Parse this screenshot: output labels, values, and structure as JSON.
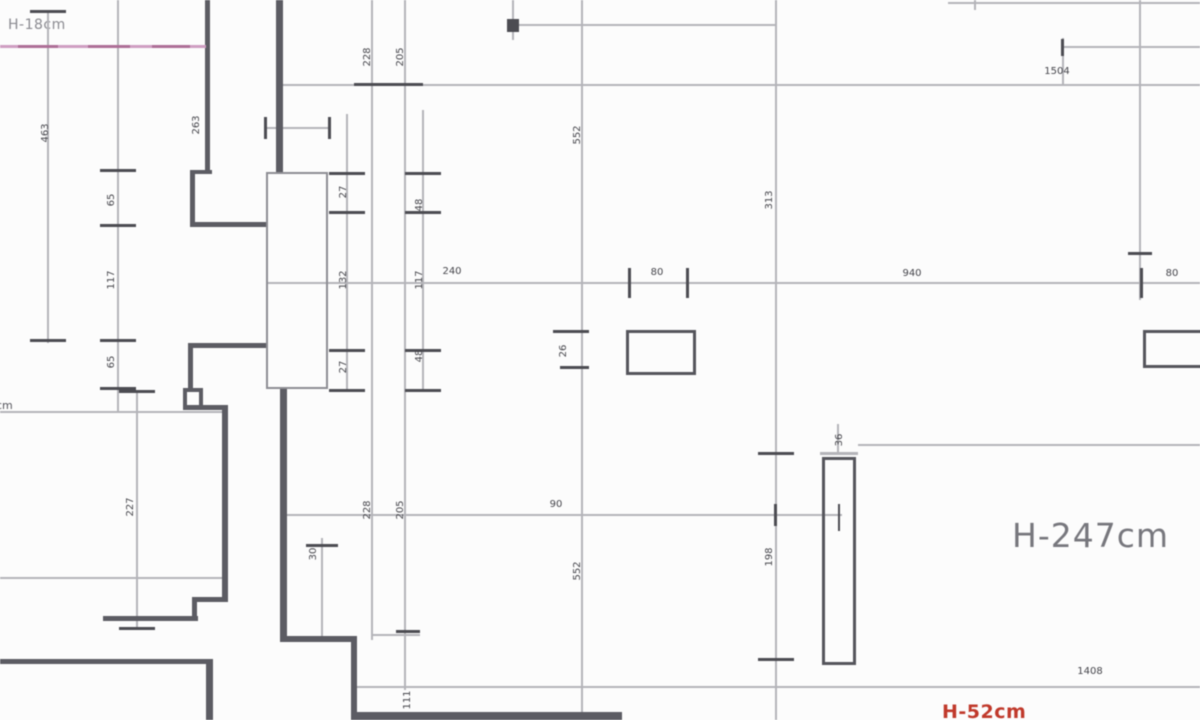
{
  "meta": {
    "app": "architectural-floor-plan-view",
    "canvas_width": 1200,
    "canvas_height": 720
  },
  "labels": {
    "top_left_height": "H-18cm",
    "main_height": "H-247cm",
    "left_edge_cut": "cm",
    "bottom_red_height": "H-52cm"
  },
  "colors": {
    "background": "#fcfcfc",
    "wall": "#5c5c63",
    "dimension_line": "#b4b4b9",
    "tick": "#4c4c52",
    "dimension_text": "#45454b",
    "big_label": "#77777d",
    "pink_line": "#cf9ec2",
    "pink_dash": "#ad6f97",
    "red_label": "#c0392b"
  },
  "drawing": {
    "pink_line": {
      "x": 0,
      "y": 45,
      "w": 206,
      "h": 3,
      "dashes": [
        [
          18,
          40
        ],
        [
          88,
          42
        ],
        [
          152,
          38
        ]
      ]
    },
    "walls": [
      {
        "x": 205,
        "y": 0,
        "w": 5,
        "h": 173
      },
      {
        "x": 190,
        "y": 170,
        "w": 22,
        "h": 4
      },
      {
        "x": 190,
        "y": 170,
        "w": 5,
        "h": 57
      },
      {
        "x": 190,
        "y": 222,
        "w": 78,
        "h": 5
      },
      {
        "x": 188,
        "y": 343,
        "w": 80,
        "h": 5
      },
      {
        "x": 188,
        "y": 343,
        "w": 5,
        "h": 47
      },
      {
        "x": 276,
        "y": 0,
        "w": 7,
        "h": 174
      },
      {
        "x": 280,
        "y": 388,
        "w": 7,
        "h": 253
      },
      {
        "x": 280,
        "y": 636,
        "w": 77,
        "h": 6
      },
      {
        "x": 351,
        "y": 636,
        "w": 6,
        "h": 84
      },
      {
        "x": 352,
        "y": 712,
        "w": 270,
        "h": 8
      },
      {
        "x": 0,
        "y": 659,
        "w": 213,
        "h": 5
      },
      {
        "x": 206,
        "y": 659,
        "w": 7,
        "h": 61
      },
      {
        "x": 222,
        "y": 405,
        "w": 6,
        "h": 196
      },
      {
        "x": 183,
        "y": 405,
        "w": 45,
        "h": 5
      },
      {
        "x": 183,
        "y": 388,
        "w": 4,
        "h": 19
      },
      {
        "x": 183,
        "y": 388,
        "w": 20,
        "h": 4
      },
      {
        "x": 199,
        "y": 388,
        "w": 4,
        "h": 19
      },
      {
        "x": 192,
        "y": 597,
        "w": 36,
        "h": 5
      },
      {
        "x": 192,
        "y": 597,
        "w": 5,
        "h": 23
      },
      {
        "x": 103,
        "y": 616,
        "w": 95,
        "h": 5
      }
    ],
    "dim_lines": [
      {
        "x": 47,
        "y": 10,
        "w": 2,
        "h": 333
      },
      {
        "x": 117,
        "y": 0,
        "w": 2,
        "h": 412
      },
      {
        "x": 136,
        "y": 390,
        "w": 2,
        "h": 240
      },
      {
        "x": 346,
        "y": 114,
        "w": 2,
        "h": 278
      },
      {
        "x": 321,
        "y": 538,
        "w": 2,
        "h": 100
      },
      {
        "x": 371,
        "y": 0,
        "w": 2,
        "h": 640
      },
      {
        "x": 404,
        "y": 0,
        "w": 2,
        "h": 690
      },
      {
        "x": 422,
        "y": 110,
        "w": 2,
        "h": 282
      },
      {
        "x": 512,
        "y": 0,
        "w": 2,
        "h": 40
      },
      {
        "x": 581,
        "y": 0,
        "w": 2,
        "h": 720
      },
      {
        "x": 775,
        "y": 0,
        "w": 2,
        "h": 720
      },
      {
        "x": 1139,
        "y": 0,
        "w": 2,
        "h": 300
      },
      {
        "x": 513,
        "y": 24,
        "w": 263,
        "h": 2
      },
      {
        "x": 1063,
        "y": 46,
        "w": 137,
        "h": 2
      },
      {
        "x": 948,
        "y": 2,
        "w": 252,
        "h": 2
      },
      {
        "x": 283,
        "y": 84,
        "w": 917,
        "h": 2
      },
      {
        "x": 266,
        "y": 282,
        "w": 934,
        "h": 2
      },
      {
        "x": 265,
        "y": 127,
        "w": 65,
        "h": 2
      },
      {
        "x": 0,
        "y": 411,
        "w": 222,
        "h": 2
      },
      {
        "x": 287,
        "y": 514,
        "w": 555,
        "h": 2
      },
      {
        "x": 0,
        "y": 577,
        "w": 225,
        "h": 2
      },
      {
        "x": 352,
        "y": 686,
        "w": 848,
        "h": 2
      },
      {
        "x": 372,
        "y": 634,
        "w": 48,
        "h": 2
      },
      {
        "x": 974,
        "y": 0,
        "w": 2,
        "h": 10
      },
      {
        "x": 1062,
        "y": 38,
        "w": 2,
        "h": 47
      },
      {
        "x": 858,
        "y": 444,
        "w": 342,
        "h": 2
      },
      {
        "x": 820,
        "y": 452,
        "w": 38,
        "h": 3
      },
      {
        "x": 837,
        "y": 424,
        "w": 2,
        "h": 30
      }
    ],
    "ticks": [
      {
        "x": 100,
        "y": 169,
        "w": 36,
        "h": 3
      },
      {
        "x": 100,
        "y": 224,
        "w": 36,
        "h": 3
      },
      {
        "x": 100,
        "y": 339,
        "w": 36,
        "h": 3
      },
      {
        "x": 100,
        "y": 387,
        "w": 36,
        "h": 3
      },
      {
        "x": 30,
        "y": 10,
        "w": 36,
        "h": 3
      },
      {
        "x": 30,
        "y": 339,
        "w": 36,
        "h": 3
      },
      {
        "x": 119,
        "y": 390,
        "w": 36,
        "h": 3
      },
      {
        "x": 119,
        "y": 627,
        "w": 36,
        "h": 3
      },
      {
        "x": 329,
        "y": 172,
        "w": 36,
        "h": 3
      },
      {
        "x": 329,
        "y": 211,
        "w": 36,
        "h": 3
      },
      {
        "x": 329,
        "y": 349,
        "w": 36,
        "h": 3
      },
      {
        "x": 329,
        "y": 389,
        "w": 36,
        "h": 3
      },
      {
        "x": 405,
        "y": 172,
        "w": 36,
        "h": 3
      },
      {
        "x": 405,
        "y": 211,
        "w": 36,
        "h": 3
      },
      {
        "x": 405,
        "y": 349,
        "w": 36,
        "h": 3
      },
      {
        "x": 405,
        "y": 389,
        "w": 36,
        "h": 3
      },
      {
        "x": 354,
        "y": 83,
        "w": 36,
        "h": 3
      },
      {
        "x": 387,
        "y": 83,
        "w": 36,
        "h": 3
      },
      {
        "x": 628,
        "y": 268,
        "w": 3,
        "h": 30
      },
      {
        "x": 686,
        "y": 268,
        "w": 3,
        "h": 30
      },
      {
        "x": 1140,
        "y": 268,
        "w": 3,
        "h": 30
      },
      {
        "x": 553,
        "y": 330,
        "w": 36,
        "h": 3
      },
      {
        "x": 560,
        "y": 366,
        "w": 29,
        "h": 3
      },
      {
        "x": 758,
        "y": 452,
        "w": 36,
        "h": 3
      },
      {
        "x": 758,
        "y": 658,
        "w": 36,
        "h": 3
      },
      {
        "x": 507,
        "y": 19,
        "w": 12,
        "h": 13
      },
      {
        "x": 1061,
        "y": 39,
        "w": 3,
        "h": 17
      },
      {
        "x": 838,
        "y": 504,
        "w": 2,
        "h": 27
      },
      {
        "x": 774,
        "y": 504,
        "w": 3,
        "h": 22
      },
      {
        "x": 1128,
        "y": 252,
        "w": 24,
        "h": 3
      },
      {
        "x": 264,
        "y": 117,
        "w": 3,
        "h": 22
      },
      {
        "x": 328,
        "y": 117,
        "w": 3,
        "h": 22
      },
      {
        "x": 396,
        "y": 630,
        "w": 24,
        "h": 3
      },
      {
        "x": 306,
        "y": 544,
        "w": 32,
        "h": 3
      }
    ],
    "rects": [
      {
        "x": 626,
        "y": 330,
        "w": 70,
        "h": 45,
        "light": false
      },
      {
        "x": 1143,
        "y": 330,
        "w": 75,
        "h": 38,
        "light": false
      },
      {
        "x": 822,
        "y": 457,
        "w": 34,
        "h": 208,
        "light": false
      },
      {
        "x": 266,
        "y": 172,
        "w": 62,
        "h": 217,
        "light": true
      }
    ],
    "dim_texts": [
      {
        "t": "463",
        "x": 46,
        "y": 133,
        "rot": true
      },
      {
        "t": "263",
        "x": 197,
        "y": 125,
        "rot": true
      },
      {
        "t": "65",
        "x": 112,
        "y": 200,
        "rot": true
      },
      {
        "t": "117",
        "x": 112,
        "y": 280,
        "rot": true
      },
      {
        "t": "65",
        "x": 112,
        "y": 362,
        "rot": true
      },
      {
        "t": "227",
        "x": 131,
        "y": 507,
        "rot": true
      },
      {
        "t": "27",
        "x": 344,
        "y": 192,
        "rot": true
      },
      {
        "t": "132",
        "x": 344,
        "y": 280,
        "rot": true
      },
      {
        "t": "27",
        "x": 344,
        "y": 367,
        "rot": true
      },
      {
        "t": "48",
        "x": 420,
        "y": 205,
        "rot": true
      },
      {
        "t": "117",
        "x": 420,
        "y": 280,
        "rot": true
      },
      {
        "t": "48",
        "x": 420,
        "y": 356,
        "rot": true
      },
      {
        "t": "228",
        "x": 368,
        "y": 57,
        "rot": true
      },
      {
        "t": "205",
        "x": 401,
        "y": 57,
        "rot": true
      },
      {
        "t": "228",
        "x": 368,
        "y": 510,
        "rot": true
      },
      {
        "t": "205",
        "x": 401,
        "y": 510,
        "rot": true
      },
      {
        "t": "552",
        "x": 578,
        "y": 135,
        "rot": true
      },
      {
        "t": "26",
        "x": 564,
        "y": 351,
        "rot": true
      },
      {
        "t": "552",
        "x": 578,
        "y": 571,
        "rot": true
      },
      {
        "t": "313",
        "x": 770,
        "y": 200,
        "rot": true
      },
      {
        "t": "198",
        "x": 770,
        "y": 557,
        "rot": true
      },
      {
        "t": "36",
        "x": 840,
        "y": 440,
        "rot": true
      },
      {
        "t": "30",
        "x": 314,
        "y": 554,
        "rot": true
      },
      {
        "t": "111",
        "x": 408,
        "y": 700,
        "rot": true
      },
      {
        "t": "80",
        "x": 657,
        "y": 273,
        "rot": false
      },
      {
        "t": "240",
        "x": 452,
        "y": 272,
        "rot": false
      },
      {
        "t": "940",
        "x": 912,
        "y": 274,
        "rot": false
      },
      {
        "t": "80",
        "x": 1172,
        "y": 274,
        "rot": false
      },
      {
        "t": "1504",
        "x": 1057,
        "y": 72,
        "rot": false
      },
      {
        "t": "1408",
        "x": 1090,
        "y": 672,
        "rot": false
      },
      {
        "t": "90",
        "x": 556,
        "y": 505,
        "rot": false
      }
    ]
  }
}
